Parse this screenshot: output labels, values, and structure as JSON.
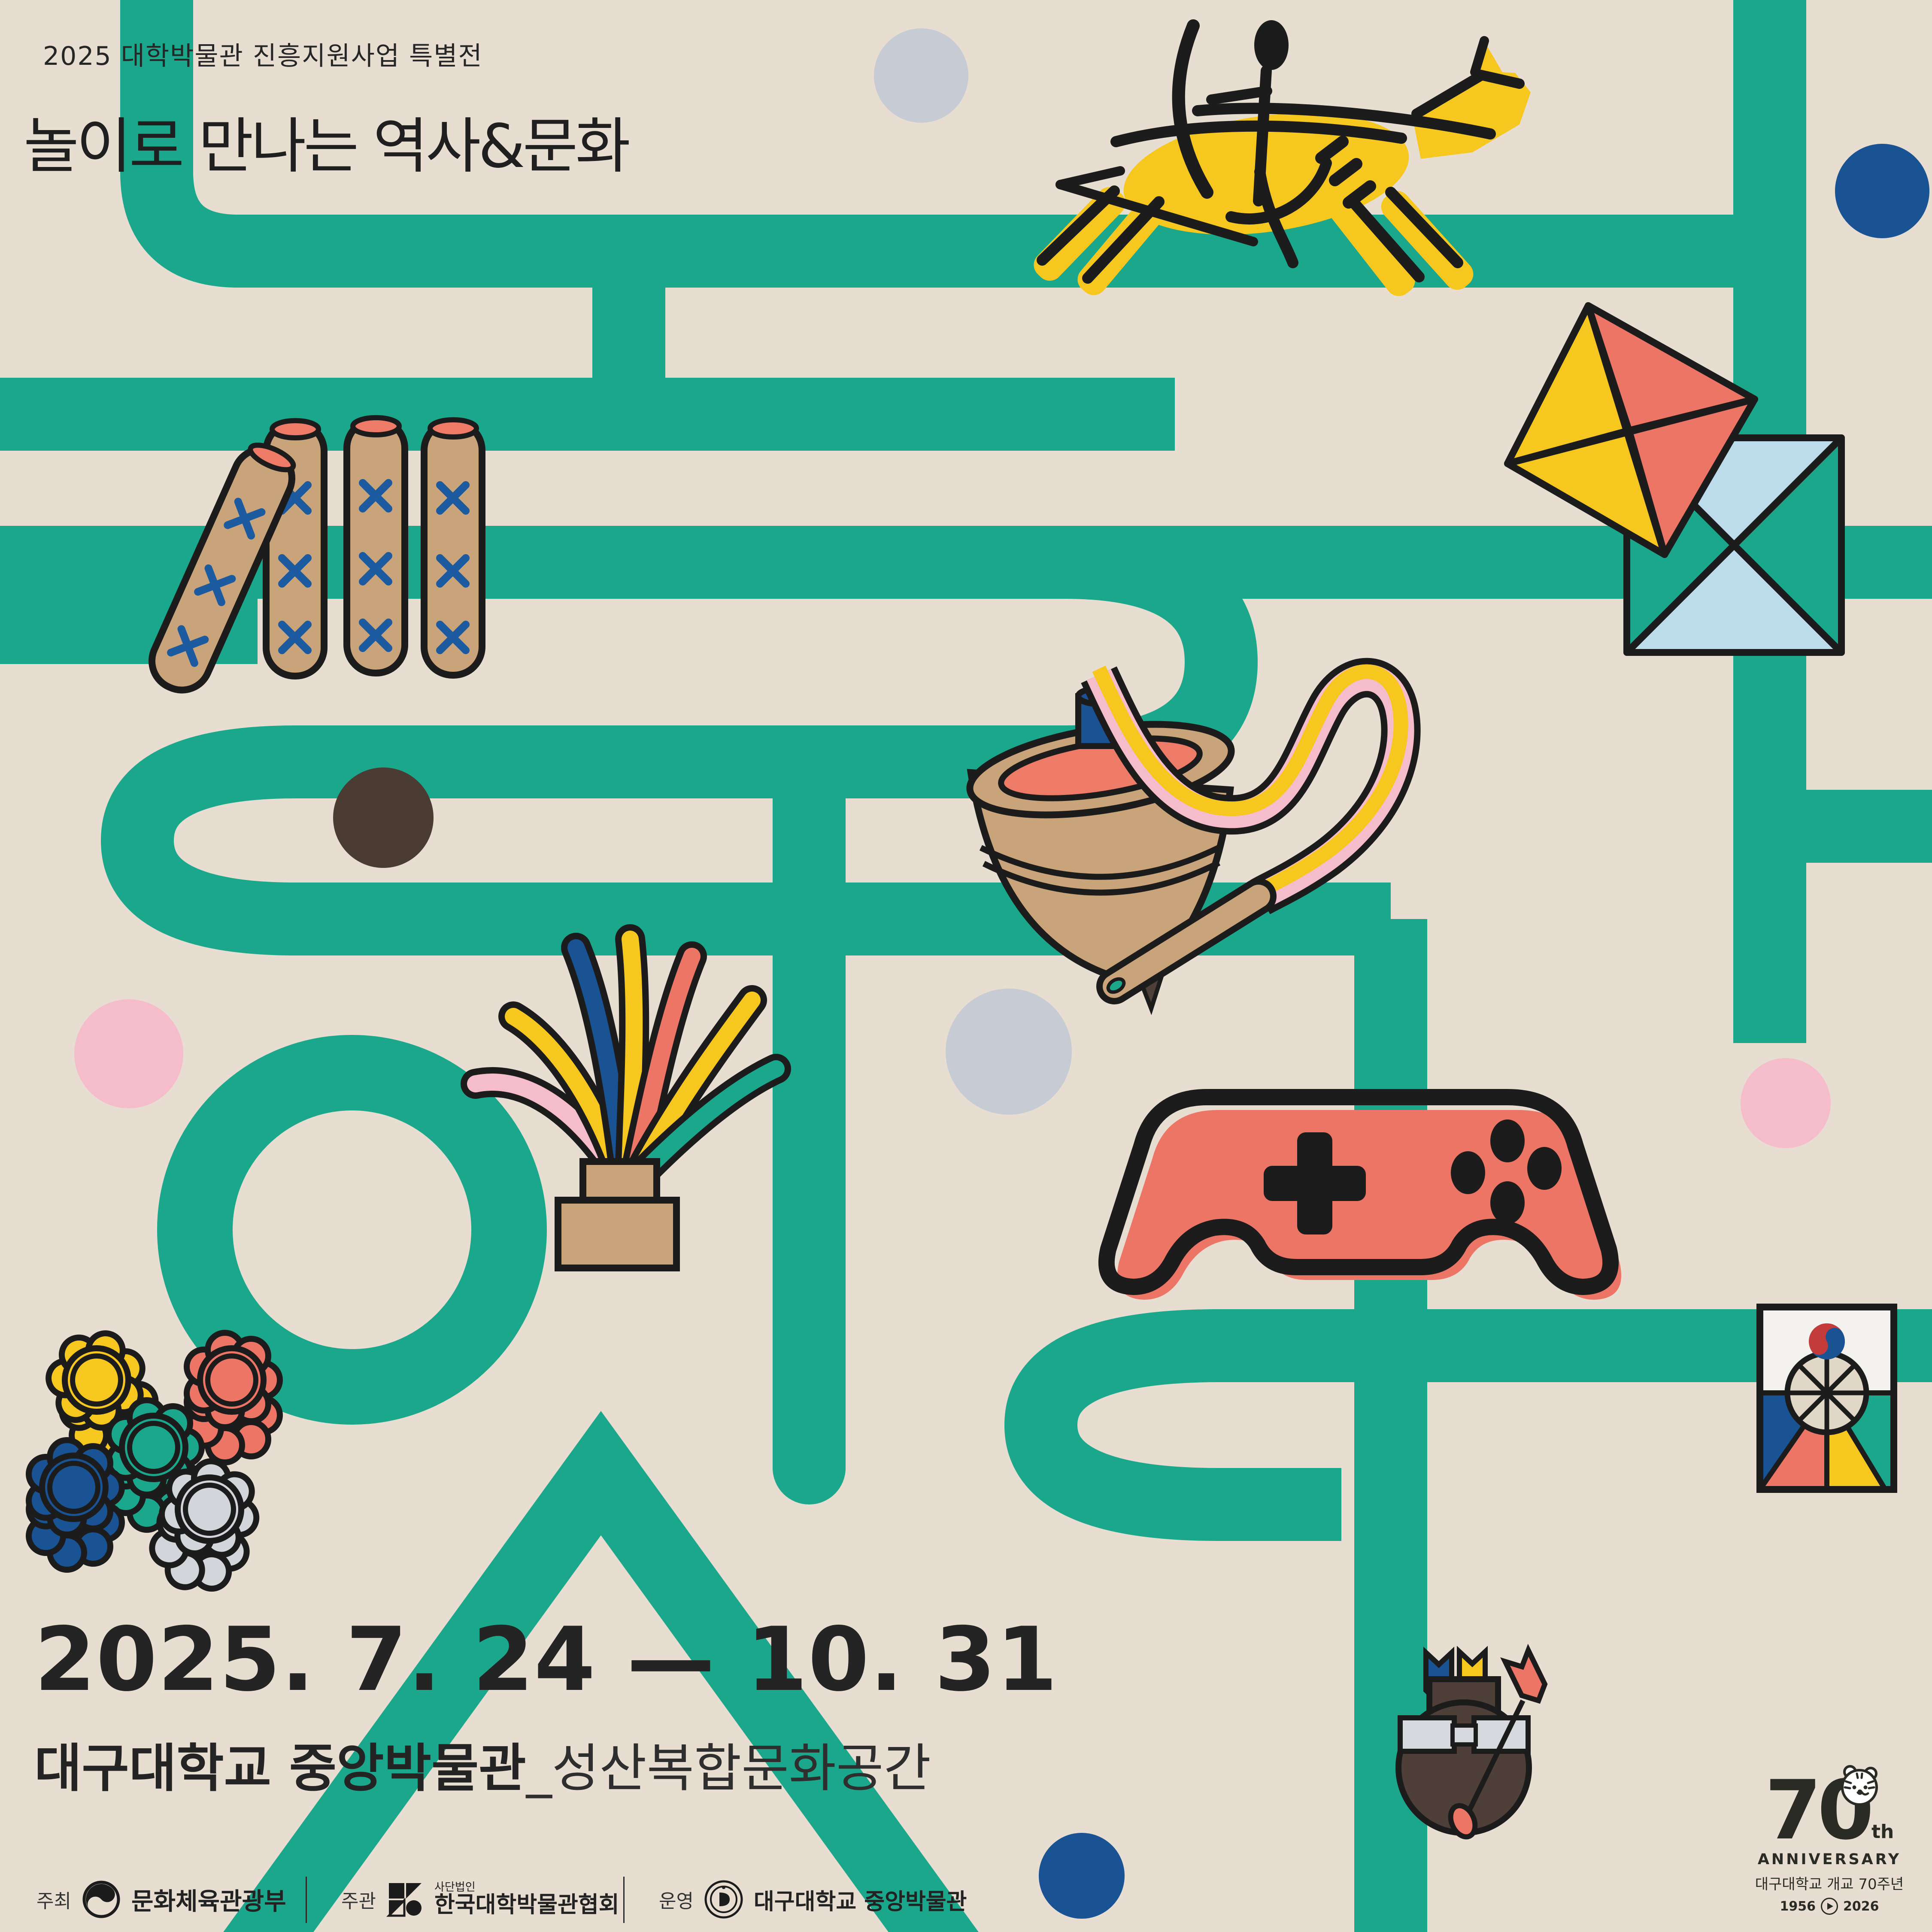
{
  "poster": {
    "top_label": "2025 대학박물관 진흥지원사업 특별전",
    "title": "놀이로 만나는 역사&문화",
    "date_range": "2025. 7. 24 — 10. 31",
    "venue_bold": "대구대학교 중앙박물관",
    "venue_light": "_성산복합문화공간"
  },
  "footer": {
    "host_label": "주최",
    "host_org": "문화체육관광부",
    "organizer_label": "주관",
    "organizer_org_small": "사단법인",
    "organizer_org": "한국대학박물관협회",
    "operator_label": "운영",
    "operator_org": "대구대학교 중앙박물관"
  },
  "anniversary": {
    "number": "70",
    "suffix": "th",
    "word": "ANNIVERSARY",
    "line_kr": "대구대학교 개교 70주년",
    "year_from": "1956",
    "year_to": "2026"
  },
  "colors": {
    "background": "#e7ded1",
    "maze_teal": "#1aa78c",
    "outline_black": "#1c1c1c",
    "yellow": "#f6c71f",
    "salmon": "#ec7565",
    "blue": "#1a5394",
    "pink": "#f5bccb",
    "light_blue": "#bcdcec",
    "tan": "#c9a47b",
    "dark_brown": "#4e4038",
    "gray": "#c7ccd4"
  },
  "icons": [
    "horse-archer-icon",
    "yut-sticks-icon",
    "kite-icon",
    "spinning-top-icon",
    "whip-icon",
    "jegi-icon",
    "gamepad-icon",
    "flower-token-icon",
    "taegeuk-fan-icon",
    "tuho-icon",
    "tiger-icon",
    "taegeuk-logo-icon",
    "museum-association-logo-icon",
    "university-seal-icon",
    "play-icon"
  ]
}
